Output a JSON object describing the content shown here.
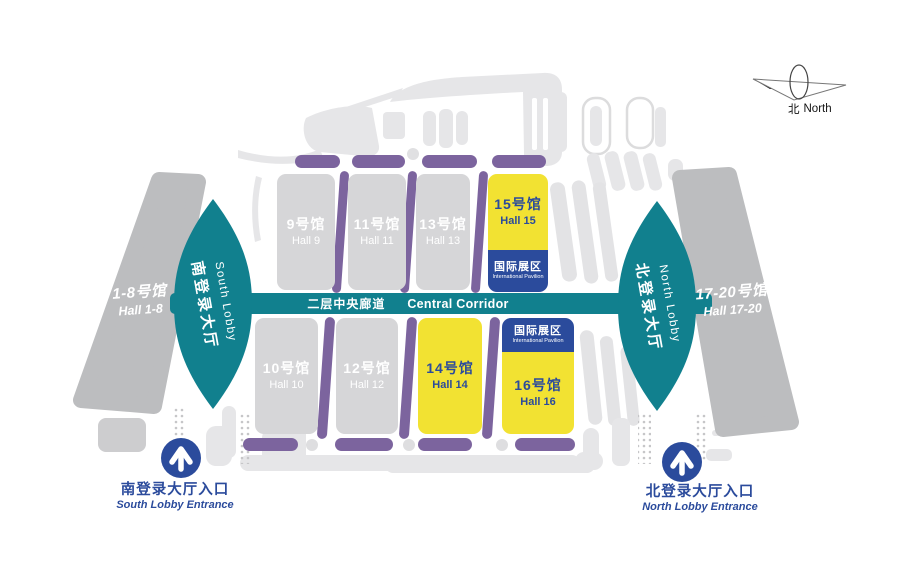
{
  "map": {
    "compass": {
      "cn": "北",
      "en": "North"
    },
    "corridor": {
      "cn": "二层中央廊道",
      "en": "Central Corridor"
    },
    "lobby_south": {
      "cn": "南登录大厅",
      "en": "South Lobby"
    },
    "lobby_north": {
      "cn": "北登录大厅",
      "en": "North Lobby"
    },
    "outer_west": {
      "cn": "1-8号馆",
      "en": "Hall 1-8"
    },
    "outer_east": {
      "cn": "17-20号馆",
      "en": "Hall 17-20"
    },
    "halls_top": [
      {
        "cn": "9号馆",
        "en": "Hall 9"
      },
      {
        "cn": "11号馆",
        "en": "Hall 11"
      },
      {
        "cn": "13号馆",
        "en": "Hall 13"
      },
      {
        "cn": "15号馆",
        "en": "Hall 15"
      }
    ],
    "halls_bottom": [
      {
        "cn": "10号馆",
        "en": "Hall 10"
      },
      {
        "cn": "12号馆",
        "en": "Hall 12"
      },
      {
        "cn": "14号馆",
        "en": "Hall 14"
      },
      {
        "cn": "16号馆",
        "en": "Hall 16"
      }
    ],
    "international_badge": {
      "cn": "国际展区",
      "en": "International Pavilion"
    },
    "entrance_south": {
      "cn": "南登录大厅入口",
      "en": "South Lobby Entrance"
    },
    "entrance_north": {
      "cn": "北登录大厅入口",
      "en": "North Lobby Entrance"
    },
    "highlighted_halls": [
      "14号馆",
      "15号馆",
      "16号馆"
    ],
    "colors": {
      "teal": "#11808e",
      "purple": "#7c649e",
      "yellow": "#f2e232",
      "blue": "#2b4b9c",
      "hall-gray": "#d6d6d8",
      "bar-gray": "#bcbdbf",
      "decor-gray": "#e6e6e8",
      "text-white": "#ffffff"
    }
  }
}
